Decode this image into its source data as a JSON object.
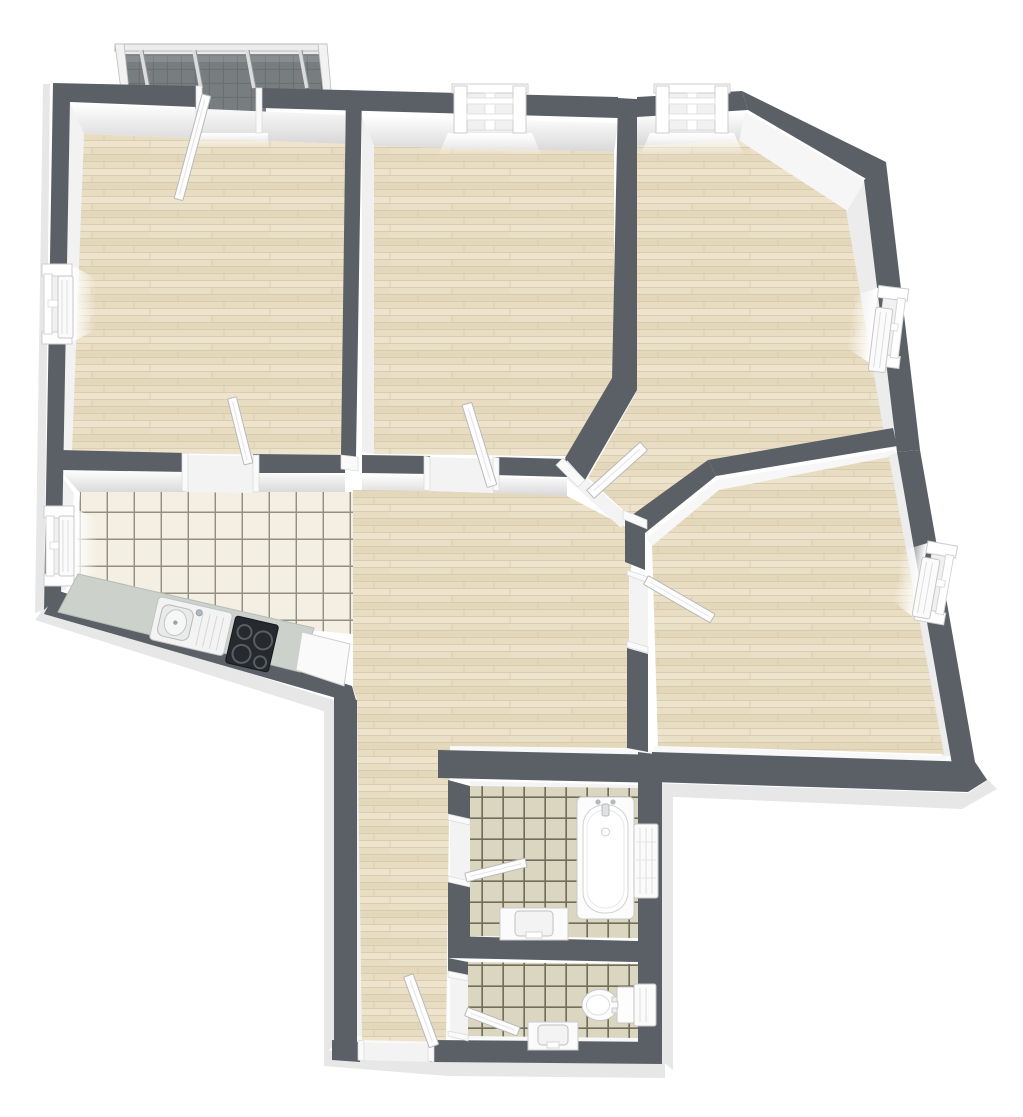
{
  "meta": {
    "description": "3D rendered top-down floor plan of an apartment, no text labels visible"
  },
  "palette": {
    "background": "#ffffff",
    "wall": "#5a6065",
    "wall_face": "#f5f5f5",
    "plinth": "#e7e7e7",
    "wood_base": "#e8ddc3",
    "wood_light": "#eee4cd",
    "wood_dark": "#e1d5b8",
    "wood_seam": "#d6caab",
    "kitchen_tile": "#f3efe2",
    "kitchen_grout": "#8a8577",
    "bath_tile": "#dad6c0",
    "bath_grout": "#5f5c49",
    "balcony_floor": "#787d80",
    "balcony_grid": "#696e71",
    "railing": "#e9e9e9",
    "counter": "#cdd1cc",
    "cooktop": "#26292d",
    "fixture": "#fdfdfd",
    "fixture_stroke": "#c3c3c3"
  },
  "rooms": [
    {
      "name": "bedroom-top-left",
      "floor": "wood",
      "openings": [
        "balcony-door",
        "door-to-kitchen"
      ],
      "windows_left_wall": 1
    },
    {
      "name": "room-top-middle",
      "floor": "wood",
      "openings": [
        "door-to-hallway"
      ],
      "windows_top_wall": 1
    },
    {
      "name": "room-top-right",
      "floor": "wood",
      "openings": [
        "door-to-hallway"
      ],
      "windows": 2
    },
    {
      "name": "room-middle-right",
      "floor": "wood",
      "openings": [
        "door-to-hallway"
      ],
      "windows": 1
    },
    {
      "name": "kitchen",
      "floor": "tile-light",
      "openings": [
        "open-to-hallway"
      ],
      "windows_left_wall": 1
    },
    {
      "name": "hallway",
      "floor": "wood",
      "openings": [
        "entrance-door"
      ]
    },
    {
      "name": "bathroom",
      "floor": "tile-beige",
      "openings": [
        "door-to-hallway"
      ]
    },
    {
      "name": "wc",
      "floor": "tile-beige",
      "openings": [
        "door-to-hallway"
      ]
    },
    {
      "name": "balcony",
      "floor": "tile-dark",
      "features": [
        "railing"
      ]
    }
  ],
  "fixtures": [
    {
      "name": "kitchen-counter",
      "room": "kitchen"
    },
    {
      "name": "kitchen-sink",
      "room": "kitchen"
    },
    {
      "name": "cooktop",
      "room": "kitchen"
    },
    {
      "name": "dishwasher",
      "room": "kitchen"
    },
    {
      "name": "bathtub",
      "room": "bathroom"
    },
    {
      "name": "vanity-sink",
      "room": "bathroom"
    },
    {
      "name": "radiator",
      "room": "bathroom"
    },
    {
      "name": "toilet",
      "room": "wc"
    },
    {
      "name": "hand-basin",
      "room": "wc"
    },
    {
      "name": "radiator",
      "room": "wc"
    },
    {
      "name": "radiator",
      "room": "room-top-right"
    },
    {
      "name": "radiator",
      "room": "room-middle-right"
    }
  ],
  "counts": {
    "windows": 6,
    "door_leaves": 8,
    "radiators": 6
  }
}
